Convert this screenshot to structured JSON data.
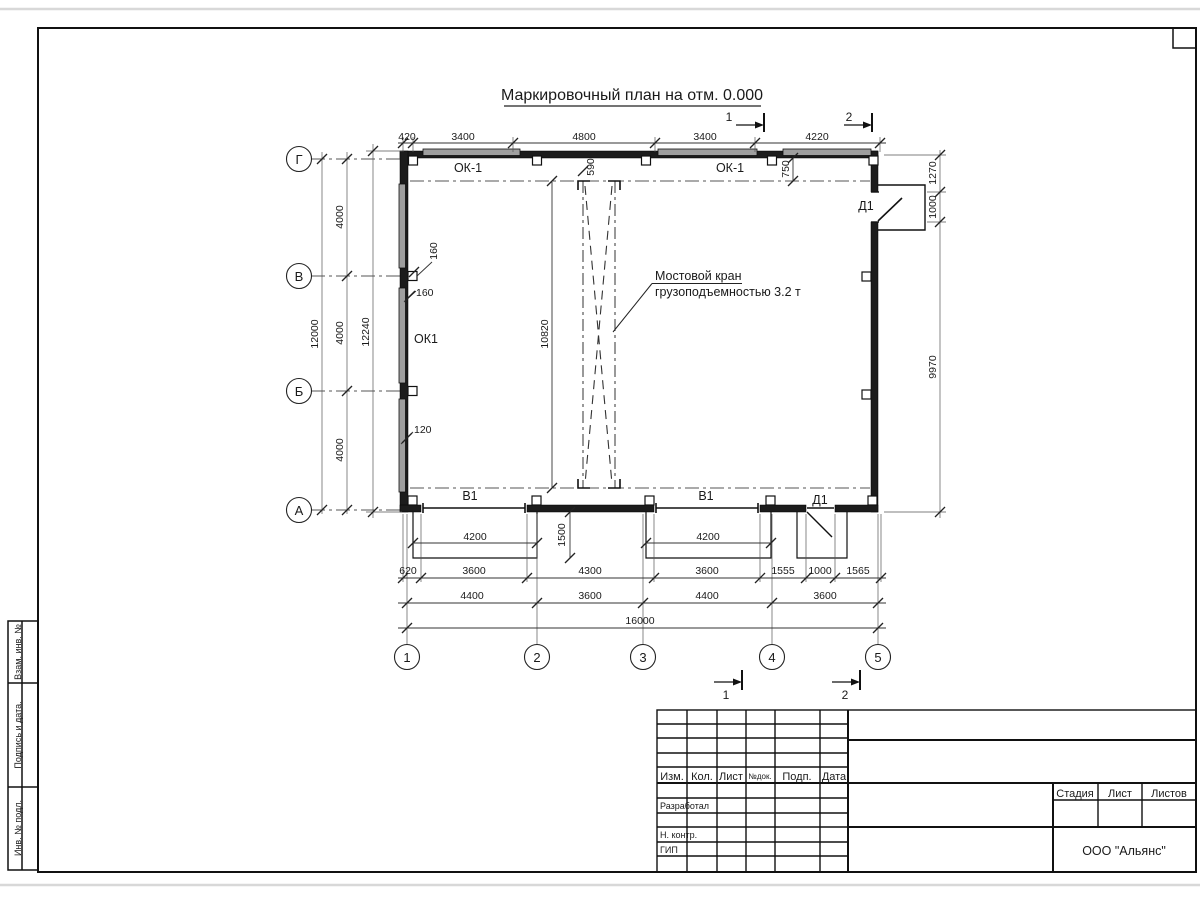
{
  "drawing": {
    "title": "Маркировочный план на отм. 0.000",
    "crane_note": {
      "line1": "Мостовой кран",
      "line2": "грузоподъемностью 3.2 т"
    },
    "axes": {
      "vertical": [
        "Г",
        "В",
        "Б",
        "А"
      ],
      "horizontal": [
        "1",
        "2",
        "3",
        "4",
        "5"
      ]
    },
    "labels": {
      "window_top_left": "ОК-1",
      "window_top_right": "ОК-1",
      "window_left_wall": "ОК1",
      "gate_left": "В1",
      "gate_right": "В1",
      "door_right": "Д1",
      "door_bottom": "Д1"
    },
    "sections": {
      "top_1": "1",
      "top_2": "2",
      "bottom_1": "1",
      "bottom_2": "2"
    },
    "dims": {
      "top": [
        "420",
        "3400",
        "4800",
        "3400",
        "4220"
      ],
      "left_segments": [
        "4000",
        "4000",
        "4000"
      ],
      "left_total": "12000",
      "left_overall": "12240",
      "right": [
        "1270",
        "1000",
        "9970"
      ],
      "crane_length": "10820",
      "crane_width": "590",
      "crane_offset": "750",
      "pilaster_1": "160",
      "pilaster_2": "160",
      "pilaster_3": "120",
      "ramp_left_width": "4200",
      "ramp_right_width": "4200",
      "ramp_depth": "1500",
      "bottom_row1": [
        "620",
        "3600",
        "4300",
        "3600",
        "1555",
        "1000",
        "1565"
      ],
      "bottom_row2": [
        "4400",
        "3600",
        "4400",
        "3600"
      ],
      "bottom_total": "16000"
    }
  },
  "title_block": {
    "header_cols": [
      "Изм.",
      "Кол.",
      "Лист",
      "№док.",
      "Подп.",
      "Дата"
    ],
    "row_developed": "Разработал",
    "row_ncontrol": "Н. контр.",
    "row_gip": "ГИП",
    "stage_cols": [
      "Стадия",
      "Лист",
      "Листов"
    ],
    "company": "ООО \"Альянс\""
  },
  "side_strip": {
    "cell_1": "Взам. инв. №",
    "cell_2": "Подпись и дата.",
    "cell_3": "Инв. № подл."
  }
}
